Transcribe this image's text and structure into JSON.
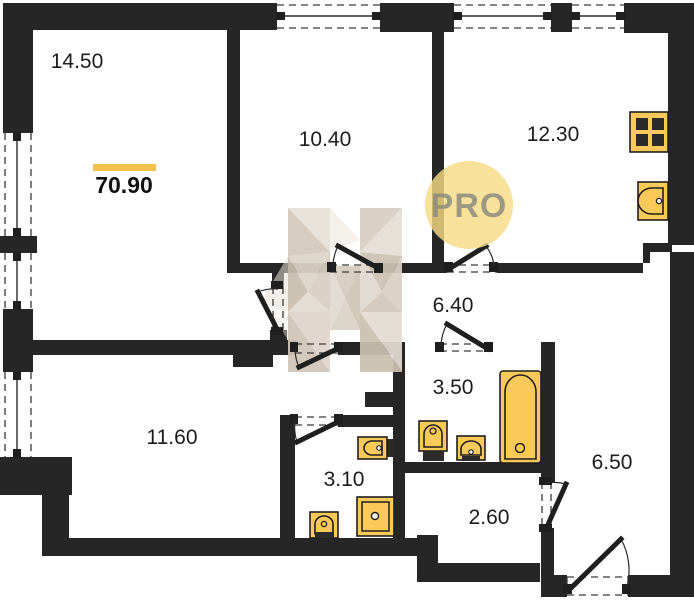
{
  "title": "Apartment floor plan",
  "total_area": {
    "value": "70.90"
  },
  "rooms": [
    {
      "id": "living-room",
      "area": "14.50"
    },
    {
      "id": "bedroom",
      "area": "10.40"
    },
    {
      "id": "kitchen",
      "area": "12.30"
    },
    {
      "id": "hallway",
      "area": "6.40"
    },
    {
      "id": "bathroom",
      "area": "3.50"
    },
    {
      "id": "bedroom-2",
      "area": "11.60"
    },
    {
      "id": "bathroom-2",
      "area": "3.10"
    },
    {
      "id": "wc",
      "area": "2.60"
    },
    {
      "id": "corridor",
      "area": "6.50"
    }
  ],
  "watermark": {
    "circle_text": "PRO",
    "letter": "H"
  },
  "colors": {
    "wall": "#262626",
    "fixture": "#F9C959",
    "total_area_bar": "#F2C14E",
    "watermark_circle": "#F6DA85",
    "watermark_text": "#8C8C7D",
    "watermark_facet": "#d8cfc2",
    "background": "#ffffff"
  }
}
